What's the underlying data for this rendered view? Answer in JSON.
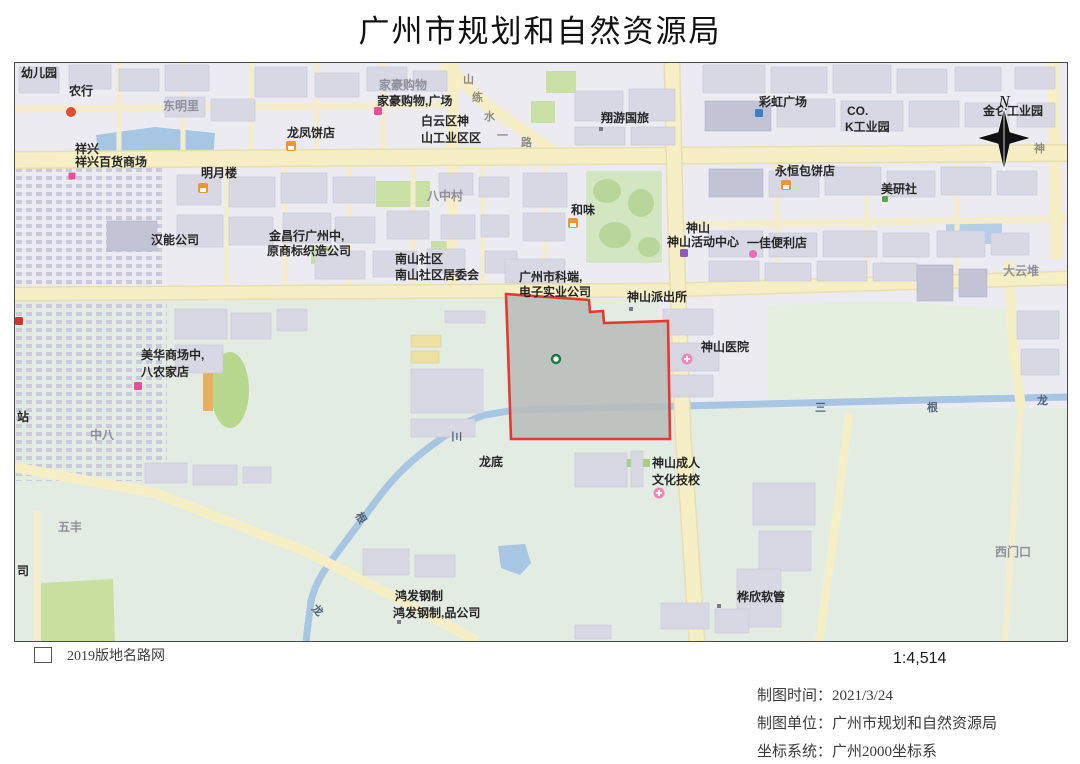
{
  "header": {
    "title": "广州市规划和自然资源局"
  },
  "legend": {
    "label": "2019版地名路网"
  },
  "scale": {
    "text": "1:4,514"
  },
  "metadata": {
    "line1": "制图时间：2021/3/24",
    "line2": "制图单位：广州市规划和自然资源局",
    "line3": "坐标系统：广州2000坐标系"
  },
  "map": {
    "north_label": "N",
    "colors": {
      "urban": "#ecebf2",
      "rural": "#e3ece3",
      "road": "#f6efc5",
      "water": "#a6c6e4",
      "building": "#d8d8e4",
      "green": "#c9e0a4",
      "parcel_fill": "#b9bdbb",
      "parcel_stroke": "#e23b2e",
      "marker": "#157a3e"
    },
    "parcel": {
      "points": "491,231 574,237 575,249 588,248 589,260 653,258 655,376 496,376 493,286",
      "marker": {
        "x": 541,
        "y": 296
      }
    },
    "labels": [
      {
        "text": "幼儿园",
        "x": 6,
        "y": 14,
        "cls": "dark"
      },
      {
        "text": "农行",
        "x": 54,
        "y": 32,
        "cls": "dark"
      },
      {
        "text": "东明里",
        "x": 148,
        "y": 47,
        "cls": "gray"
      },
      {
        "text": "祥兴",
        "x": 60,
        "y": 90,
        "cls": "dark"
      },
      {
        "text": "祥兴百货商场",
        "x": 60,
        "y": 103,
        "cls": "dark"
      },
      {
        "text": "明月楼",
        "x": 186,
        "y": 114,
        "cls": "dark"
      },
      {
        "text": "汉能公司",
        "x": 136,
        "y": 181,
        "cls": "dark"
      },
      {
        "text": "金昌行广州中,",
        "x": 254,
        "y": 177,
        "cls": "dark"
      },
      {
        "text": "原商标织造公司",
        "x": 252,
        "y": 192,
        "cls": "dark"
      },
      {
        "text": "家豪购物",
        "x": 364,
        "y": 26,
        "cls": "gray"
      },
      {
        "text": "家豪购物,广场",
        "x": 362,
        "y": 42,
        "cls": "dark"
      },
      {
        "text": "龙凤饼店",
        "x": 272,
        "y": 74,
        "cls": "dark"
      },
      {
        "text": "白云区神",
        "x": 406,
        "y": 62,
        "cls": "dark"
      },
      {
        "text": "山工业区区",
        "x": 406,
        "y": 79,
        "cls": "dark"
      },
      {
        "text": "八中村",
        "x": 412,
        "y": 137,
        "cls": "gray"
      },
      {
        "text": "南山社区",
        "x": 380,
        "y": 200,
        "cls": "dark"
      },
      {
        "text": "南山社区居委会",
        "x": 380,
        "y": 216,
        "cls": "dark"
      },
      {
        "text": "翔游国旅",
        "x": 586,
        "y": 59,
        "cls": "dark"
      },
      {
        "text": "彩虹广场",
        "x": 744,
        "y": 43,
        "cls": "dark"
      },
      {
        "text": "CO.",
        "x": 832,
        "y": 52,
        "cls": "dark"
      },
      {
        "text": "K工业园",
        "x": 830,
        "y": 68,
        "cls": "dark"
      },
      {
        "text": "金仑工业园",
        "x": 968,
        "y": 52,
        "cls": "dark"
      },
      {
        "text": "永恒包饼店",
        "x": 760,
        "y": 112,
        "cls": "dark"
      },
      {
        "text": "美研社",
        "x": 866,
        "y": 130,
        "cls": "dark"
      },
      {
        "text": "和味",
        "x": 556,
        "y": 151,
        "cls": "dark"
      },
      {
        "text": "神山",
        "x": 671,
        "y": 169,
        "cls": "dark"
      },
      {
        "text": "神山活动中心",
        "x": 652,
        "y": 183,
        "cls": "dark"
      },
      {
        "text": "一佳便利店",
        "x": 732,
        "y": 184,
        "cls": "dark"
      },
      {
        "text": "大云堆",
        "x": 988,
        "y": 212,
        "cls": "gray"
      },
      {
        "text": "广州市科端,",
        "x": 504,
        "y": 218,
        "cls": "dark"
      },
      {
        "text": "电子实业公司",
        "x": 504,
        "y": 233,
        "cls": "dark"
      },
      {
        "text": "神山派出所",
        "x": 612,
        "y": 238,
        "cls": "dark"
      },
      {
        "text": "神山医院",
        "x": 686,
        "y": 288,
        "cls": "dark"
      },
      {
        "text": "美华商场中,",
        "x": 126,
        "y": 296,
        "cls": "dark"
      },
      {
        "text": "八农家店",
        "x": 126,
        "y": 313,
        "cls": "dark"
      },
      {
        "text": "中八",
        "x": 75,
        "y": 376,
        "cls": "gray"
      },
      {
        "text": "站",
        "x": 2,
        "y": 358,
        "cls": "dark"
      },
      {
        "text": "龙底",
        "x": 464,
        "y": 403,
        "cls": "dark"
      },
      {
        "text": "神山成人",
        "x": 637,
        "y": 404,
        "cls": "dark"
      },
      {
        "text": "文化技校",
        "x": 637,
        "y": 421,
        "cls": "dark"
      },
      {
        "text": "五丰",
        "x": 43,
        "y": 468,
        "cls": "gray"
      },
      {
        "text": "司",
        "x": 2,
        "y": 512,
        "cls": "dark"
      },
      {
        "text": "鸿发钢制",
        "x": 380,
        "y": 537,
        "cls": "dark"
      },
      {
        "text": "鸿发钢制,品公司",
        "x": 378,
        "y": 554,
        "cls": "dark"
      },
      {
        "text": "桦欣软管",
        "x": 722,
        "y": 538,
        "cls": "dark"
      },
      {
        "text": "西门口",
        "x": 980,
        "y": 493,
        "cls": "gray"
      },
      {
        "text": "山",
        "x": 448,
        "y": 20,
        "cls": "road"
      },
      {
        "text": "练",
        "x": 457,
        "y": 38,
        "cls": "road"
      },
      {
        "text": "水",
        "x": 469,
        "y": 57,
        "cls": "road"
      },
      {
        "text": "一",
        "x": 482,
        "y": 76,
        "cls": "road"
      },
      {
        "text": "路",
        "x": 506,
        "y": 83,
        "cls": "road"
      },
      {
        "text": "神",
        "x": 1019,
        "y": 89,
        "cls": "road"
      },
      {
        "text": "三",
        "x": 438,
        "y": 368,
        "cls": "water",
        "rot": 90
      },
      {
        "text": "三",
        "x": 800,
        "y": 348,
        "cls": "water"
      },
      {
        "text": "根",
        "x": 912,
        "y": 348,
        "cls": "water"
      },
      {
        "text": "龙",
        "x": 1022,
        "y": 341,
        "cls": "water"
      },
      {
        "text": "根",
        "x": 340,
        "y": 452,
        "cls": "water",
        "rot": 60
      },
      {
        "text": "龙",
        "x": 296,
        "y": 546,
        "cls": "water",
        "rot": 45
      }
    ],
    "icons": [
      {
        "name": "bank-icon",
        "shape": "circle",
        "x": 56,
        "y": 49,
        "color": "#dd4f2e",
        "size": 10
      },
      {
        "name": "store-icon-xiangxing",
        "shape": "square",
        "x": 57,
        "y": 113,
        "color": "#e84f9b",
        "size": 7
      },
      {
        "name": "bakery-icon-longfeng",
        "shape": "shop",
        "x": 276,
        "y": 83,
        "color": "#ef9433",
        "size": 10
      },
      {
        "name": "shop-icon-jiahao",
        "shape": "square",
        "x": 363,
        "y": 48,
        "color": "#e84f9b",
        "size": 8
      },
      {
        "name": "restaurant-icon-mingyuelou",
        "shape": "shop",
        "x": 188,
        "y": 125,
        "color": "#ef9433",
        "size": 10
      },
      {
        "name": "restaurant-icon-hewei",
        "shape": "shop",
        "x": 558,
        "y": 160,
        "color": "#ef9433",
        "size": 10
      },
      {
        "name": "bakery-icon-yongheng",
        "shape": "shop",
        "x": 771,
        "y": 122,
        "color": "#ef9433",
        "size": 10
      },
      {
        "name": "plaza-icon-caihong",
        "shape": "square",
        "x": 744,
        "y": 50,
        "color": "#3e7ec2",
        "size": 8
      },
      {
        "name": "studio-icon-meiyanshe",
        "shape": "square",
        "x": 870,
        "y": 136,
        "color": "#57a546",
        "size": 6
      },
      {
        "name": "activity-center-icon-shenshan",
        "shape": "square",
        "x": 669,
        "y": 190,
        "color": "#8e5bb8",
        "size": 8
      },
      {
        "name": "store-icon-yijia",
        "shape": "circle",
        "x": 738,
        "y": 191,
        "color": "#e96bb0",
        "size": 8
      },
      {
        "name": "hospital-icon-shenshan",
        "shape": "cross",
        "x": 672,
        "y": 296,
        "color": "#ef86b4",
        "size": 11
      },
      {
        "name": "school-icon-wenhua",
        "shape": "cross",
        "x": 644,
        "y": 430,
        "color": "#ef86b4",
        "size": 11
      },
      {
        "name": "poi-dot-xiangyou",
        "shape": "dot",
        "x": 586,
        "y": 66,
        "color": "#7a7a86",
        "size": 4
      },
      {
        "name": "poi-dot-paichusuo",
        "shape": "dot",
        "x": 616,
        "y": 246,
        "color": "#7a7a86",
        "size": 4
      },
      {
        "name": "poi-dot-huaxin",
        "shape": "dot",
        "x": 704,
        "y": 543,
        "color": "#7a7a86",
        "size": 4
      },
      {
        "name": "poi-dot-hongfa",
        "shape": "dot",
        "x": 384,
        "y": 559,
        "color": "#7a7a86",
        "size": 4
      },
      {
        "name": "mall-icon-meihua",
        "shape": "square",
        "x": 123,
        "y": 323,
        "color": "#e84f9b",
        "size": 8
      },
      {
        "name": "edge-poi-icon",
        "shape": "square",
        "x": 4,
        "y": 258,
        "color": "#c9392f",
        "size": 8
      },
      {
        "name": "parcel-center-marker",
        "shape": "ring",
        "x": 541,
        "y": 296,
        "color": "#157a3e",
        "size": 10
      }
    ]
  }
}
